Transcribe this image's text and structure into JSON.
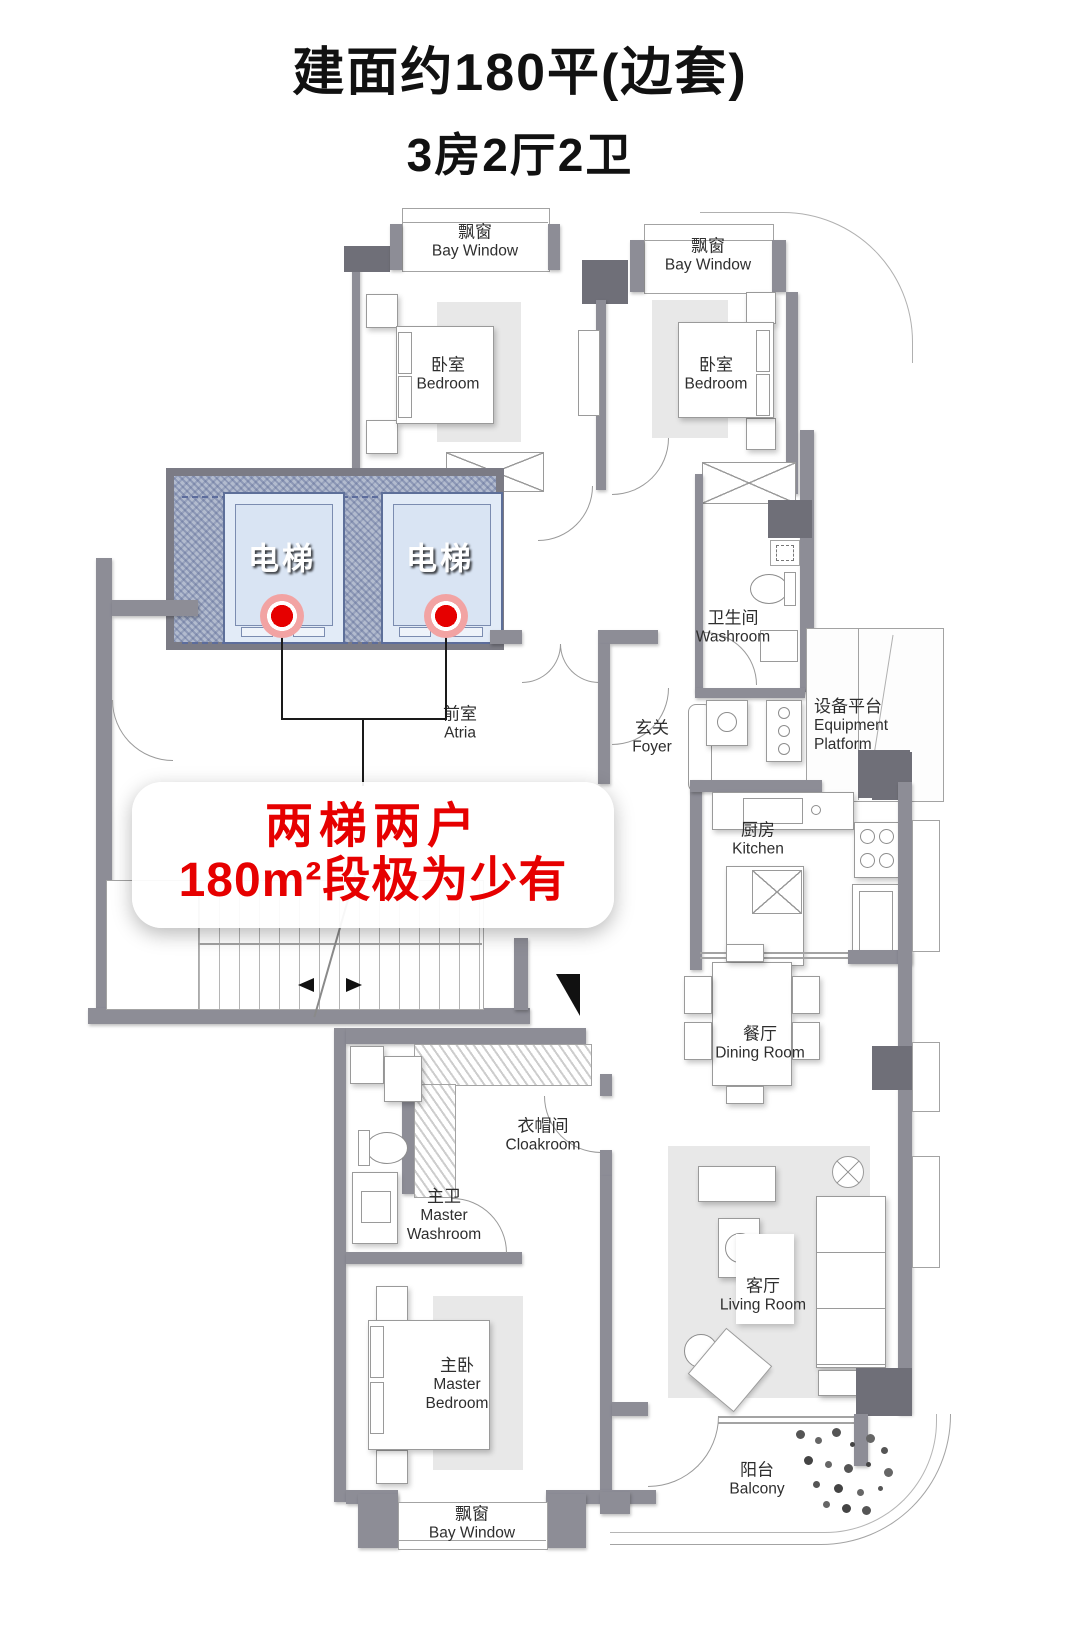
{
  "title": {
    "line1": "建面约180平(边套)",
    "line2": "3房2厅2卫"
  },
  "annotation": {
    "line1": "两梯两户",
    "line2": "180m²段极为少有"
  },
  "elevators": [
    {
      "label": "电梯"
    },
    {
      "label": "电梯"
    }
  ],
  "rooms": {
    "bay_window_left": {
      "zh": "飘窗",
      "en": "Bay Window"
    },
    "bay_window_right": {
      "zh": "飘窗",
      "en": "Bay Window"
    },
    "bay_window_bottom": {
      "zh": "飘窗",
      "en": "Bay Window"
    },
    "bedroom_left": {
      "zh": "卧室",
      "en": "Bedroom"
    },
    "bedroom_right": {
      "zh": "卧室",
      "en": "Bedroom"
    },
    "atria": {
      "zh": "前室",
      "en": "Atria"
    },
    "foyer": {
      "zh": "玄关",
      "en": "Foyer"
    },
    "washroom": {
      "zh": "卫生间",
      "en": "Washroom"
    },
    "equipment_platform": {
      "zh": "设备平台",
      "en": "Equipment Platform"
    },
    "kitchen": {
      "zh": "厨房",
      "en": "Kitchen"
    },
    "dining_room": {
      "zh": "餐厅",
      "en": "Dining Room"
    },
    "cloakroom": {
      "zh": "衣帽间",
      "en": "Cloakroom"
    },
    "master_washroom": {
      "zh": "主卫",
      "en": "Master Washroom"
    },
    "master_bedroom": {
      "zh": "主卧",
      "en": "Master Bedroom"
    },
    "living_room": {
      "zh": "客厅",
      "en": "Living Room"
    },
    "balcony": {
      "zh": "阳台",
      "en": "Balcony"
    }
  },
  "colors": {
    "wall": "#8d8d96",
    "wall_dark": "#6f6f78",
    "elevator_fill": "#e2ebf7",
    "elevator_shaft": "#b2bbce",
    "highlight_red": "#e60000",
    "marker_red": "#e60000",
    "rug": "#e8e8e8"
  }
}
